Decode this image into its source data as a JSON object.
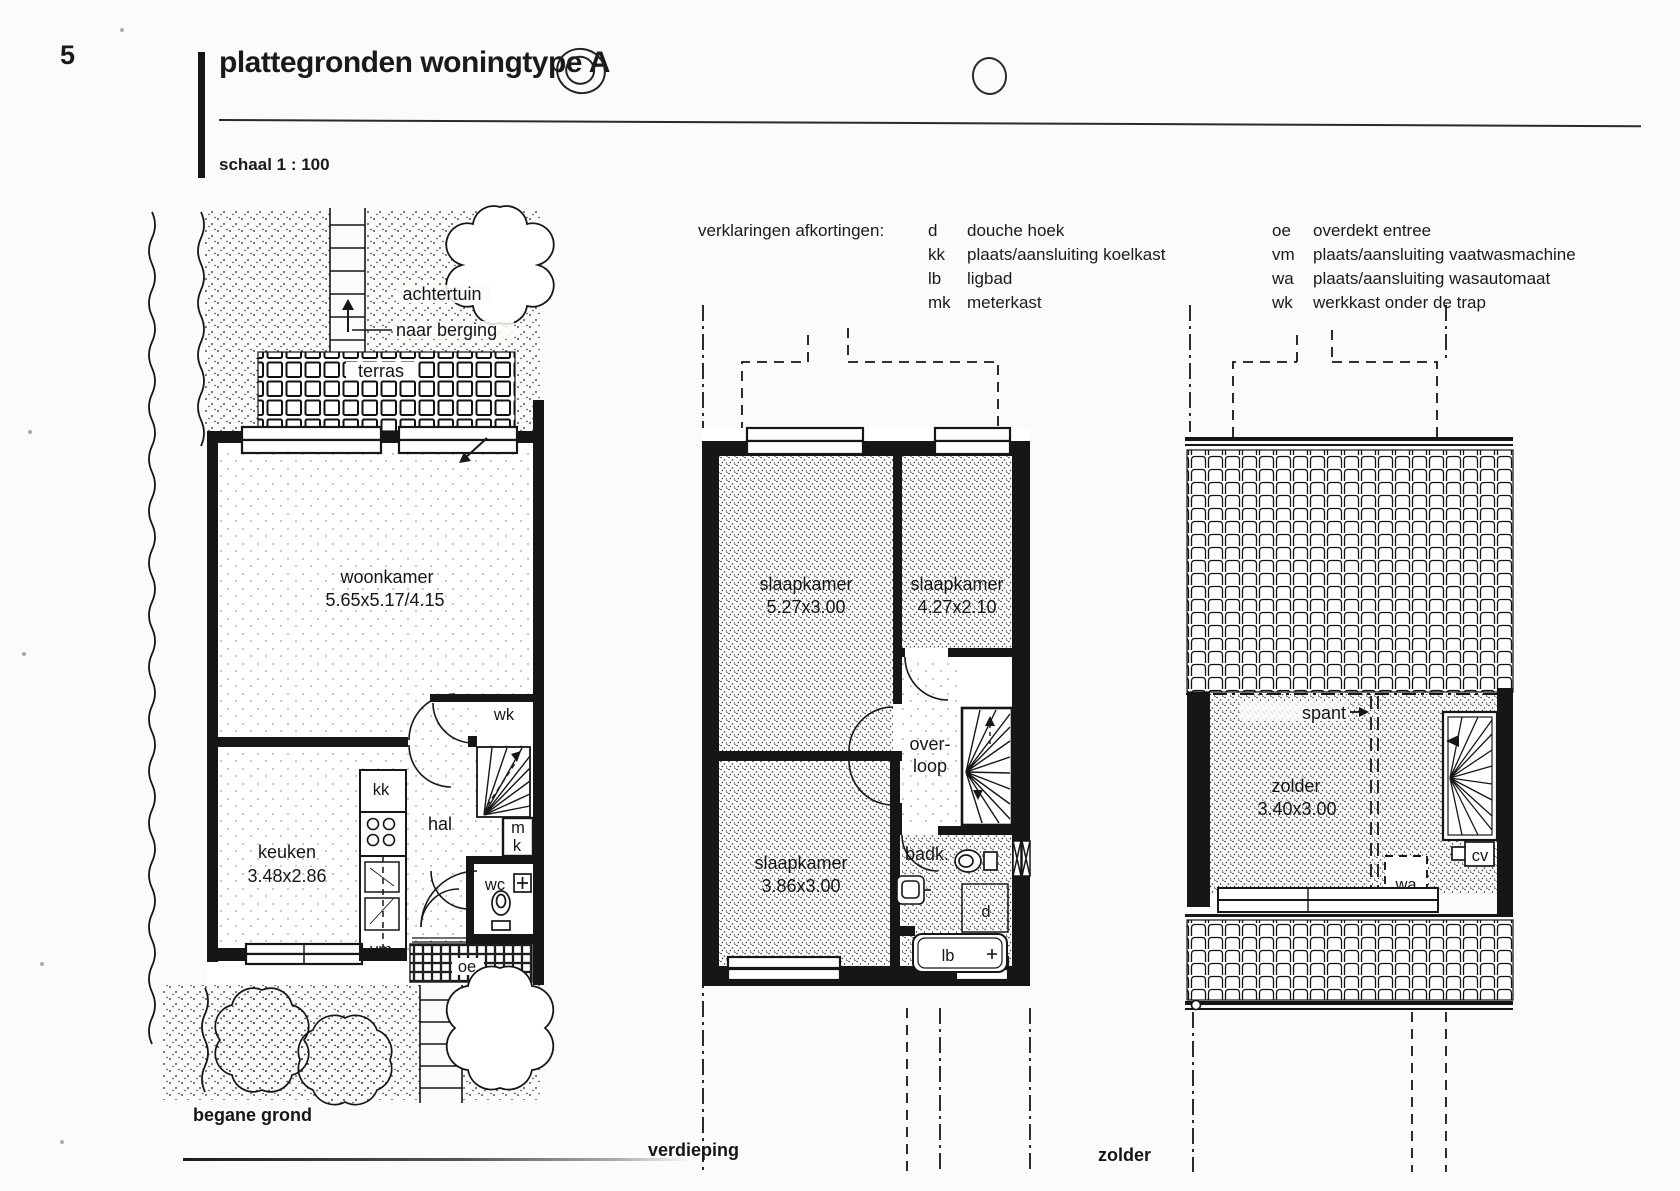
{
  "page": {
    "number": "5",
    "title": "plattegronden woningtype A",
    "scale_label": "schaal 1 : 100"
  },
  "legend": {
    "heading": "verklaringen afkortingen:",
    "col1": [
      {
        "abbr": "d",
        "desc": "douche hoek"
      },
      {
        "abbr": "kk",
        "desc": "plaats/aansluiting koelkast"
      },
      {
        "abbr": "lb",
        "desc": "ligbad"
      },
      {
        "abbr": "mk",
        "desc": "meterkast"
      }
    ],
    "col2": [
      {
        "abbr": "oe",
        "desc": "overdekt entree"
      },
      {
        "abbr": "vm",
        "desc": "plaats/aansluiting vaatwasmachine"
      },
      {
        "abbr": "wa",
        "desc": "plaats/aansluiting wasautomaat"
      },
      {
        "abbr": "wk",
        "desc": "werkkast onder de trap"
      }
    ]
  },
  "ground_floor": {
    "caption": "begane grond",
    "garden_back": "achtertuin",
    "to_shed": "naar berging",
    "terrace": "terras",
    "living_room": "woonkamer",
    "living_room_size": "5.65x5.17/4.15",
    "closet": "wk",
    "fridge": "kk",
    "hall": "hal",
    "meter_m": "m",
    "meter_k": "k",
    "kitchen": "keuken",
    "kitchen_size": "3.48x2.86",
    "toilet": "wc",
    "dishwasher": "vm",
    "entrance": "oe"
  },
  "first_floor": {
    "caption": "verdieping",
    "bedroom1": "slaapkamer",
    "bedroom1_size": "5.27x3.00",
    "bedroom2": "slaapkamer",
    "bedroom2_size": "4.27x2.10",
    "bedroom3": "slaapkamer",
    "bedroom3_size": "3.86x3.00",
    "landing_line1": "over-",
    "landing_line2": "loop",
    "bathroom": "badk.",
    "shower": "d",
    "bath": "lb"
  },
  "attic": {
    "caption": "zolder",
    "truss": "spant",
    "room": "zolder",
    "room_size": "3.40x3.00",
    "washer": "wa",
    "heater": "cv"
  }
}
